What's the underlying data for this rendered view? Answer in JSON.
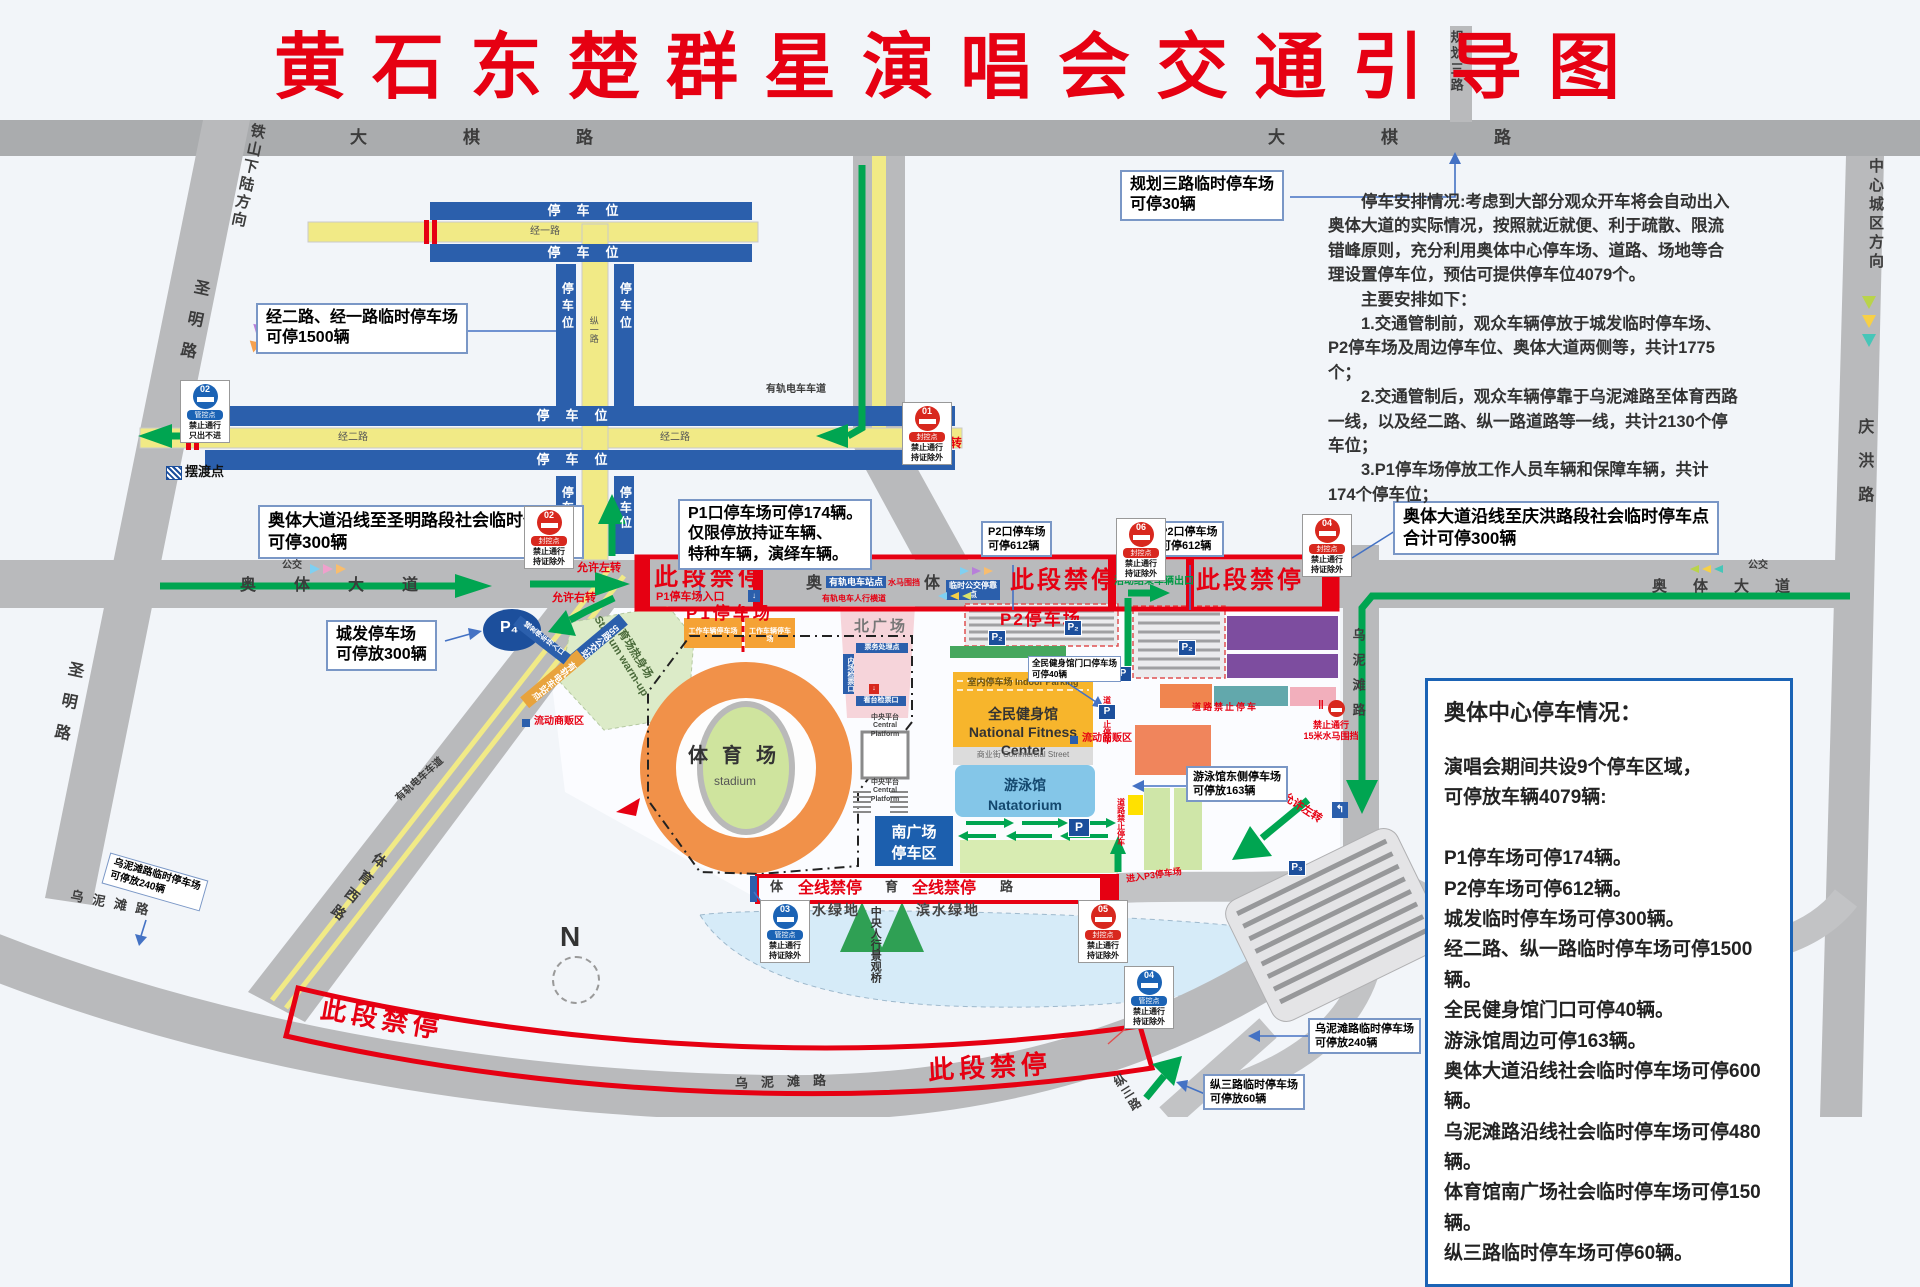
{
  "title": "黄石东楚群星演唱会交通引导图",
  "info_panel": {
    "text": "　　停车安排情况:考虑到大部分观众开车将会自动出入\n奥体大道的实际情况，按照就近就便、利于疏散、限流\n错峰原则，充分利用奥体中心停车场、道路、场地等合\n理设置停车位，预估可提供停车位4079个。\n　　主要安排如下：\n　　1.交通管制前，观众车辆停放于城发临时停车场、\nP2停车场及周边停车位、奥体大道两侧等，共计1775\n个；\n　　2.交通管制后，观众车辆停靠于乌泥滩路至体育西路\n一线，以及经二路、纵一路道路等一线，共计2130个停\n车位；\n　　3.P1停车场停放工作人员车辆和保障车辆，共计\n174个停车位；"
  },
  "parking_box": {
    "title": "奥体中心停车情况：",
    "body": "演唱会期间共设9个停车区域，\n可停放车辆4079辆:\n\nP1停车场可停174辆。\nP2停车场可停612辆。\n城发临时停车场可停300辆。\n经二路、纵一路临时停车场可停1500辆。\n全民健身馆门口可停40辆。\n游泳馆周边可停163辆。\n奥体大道沿线社会临时停车场可停600辆。\n乌泥滩路沿线社会临时停车场可停480辆。\n体育馆南广场社会临时停车场可停150辆。\n纵三路临时停车场可停60辆。"
  },
  "callouts": {
    "guihua": "规划三路临时停车场\n可停30辆",
    "jinger": "经二路、经一路临时停车场\n可停1500辆",
    "shengming": "奥体大道沿线至圣明路段社会临时停车点\n可停300辆",
    "chengfa": "城发停车场\n可停放300辆",
    "p1": "P1口停车场可停174辆。\n仅限停放持证车辆、\n特种车辆，演绎车辆。",
    "p2a": "P2口停车场\n可停612辆",
    "p2b": "P2口停车场\n可停612辆",
    "qinghong": "奥体大道沿线至庆洪路段社会临时停车点\n合计可停300辆",
    "jianshen": "全民健身馆门口停车场\n可停40辆",
    "youyong": "游泳馆东侧停车场\n可停放163辆",
    "wunitan_left": "乌泥滩路临时停车场\n可停放240辆",
    "wunitan_right": "乌泥滩路临时停车场\n可停放240辆",
    "zongsan": "纵三路临时停车场\n可停放60辆"
  },
  "banners": {
    "cd": "此段禁停",
    "qx": "全线禁停",
    "p1_entrance": "P1停车场入口",
    "exit": "活动结束车辆出口"
  },
  "roads": {
    "daqi": "大棋路",
    "guihua": "规划三路",
    "tieshan": "铁山下陆方向",
    "shengming": "圣明路",
    "jingyi": "经一路",
    "jinger": "经二路",
    "zongyi": "纵一路",
    "aoti": "奥体大道",
    "ao": "奥",
    "ti": "体",
    "tiyuxi": "体育西路",
    "wunitan": "乌泥滩路",
    "tiyu": "体育路",
    "zongsan": "纵三路",
    "qinghong": "庆洪路",
    "zhongxin": "中心城区方向",
    "gongjiao": "公交"
  },
  "areas": {
    "stadium": "体育场",
    "stadium_en": "stadium",
    "warmup": "体育场热身场\nStadium warm-up",
    "north_plaza": "北广场",
    "south_box": "南广场\n停车区",
    "fitness": "全民健身馆\nNational Fitness Center",
    "indoor": "室内停车场 Indoor Parking",
    "street": "商业街 Commercial Street",
    "pool": "游泳馆\nNatatorium",
    "platform": "中央平台\nCentral Platform",
    "p1_lot": "P1停车场",
    "p2_lot": "P2停车场",
    "work_lot": "工作车辆停车场",
    "waterside": "滨水绿地",
    "bridge": "中央人行景观桥",
    "ticket1": "票务处理点",
    "ticket2": "内场检票口",
    "ticket3": "看台检票口"
  },
  "signs": {
    "s01": {
      "num": "01",
      "type": "封控点",
      "text": "禁止通行\n持证除外"
    },
    "s02r": {
      "num": "02",
      "type": "封控点",
      "text": "禁止通行\n持证除外"
    },
    "s02b": {
      "num": "02",
      "type": "管控点",
      "text": "禁止通行\n只出不进"
    },
    "s03": {
      "num": "03",
      "type": "管控点",
      "text": "禁止通行\n持证除外"
    },
    "s04b": {
      "num": "04",
      "type": "管控点",
      "text": "禁止通行\n持证除外"
    },
    "s04r": {
      "num": "04",
      "type": "封控点",
      "text": "禁止通行\n持证除外"
    },
    "s05": {
      "num": "05",
      "type": "封控点",
      "text": "禁止通行\n持证除外"
    },
    "s06": {
      "num": "06",
      "type": "封控点",
      "text": "禁止通行\n持证除外"
    }
  },
  "markers": {
    "baidu": "摆渡点",
    "left_turn": "允许左转",
    "right_turn": "允许右转",
    "tram_stop": "有轨电车站点",
    "tram_cross": "有轨电车人行横道",
    "water_barrier": "水马围挡",
    "bus_temp": "临时公交停靠点",
    "bus55": "55路公交站点",
    "tram_lane": "有轨电车车道",
    "chengfa_entry": "城发停车场入口",
    "vendor": "流动商贩区",
    "no_pass_15": "禁止通行\n15米水马围挡",
    "no_park_road": "道路禁止停车",
    "p3_entry": "进入P3停车场",
    "parking_spot": "停车位",
    "compass": "N"
  },
  "badges": {
    "p": "P",
    "p2": "P₂",
    "p3": "P₃",
    "p4": "P₄"
  }
}
